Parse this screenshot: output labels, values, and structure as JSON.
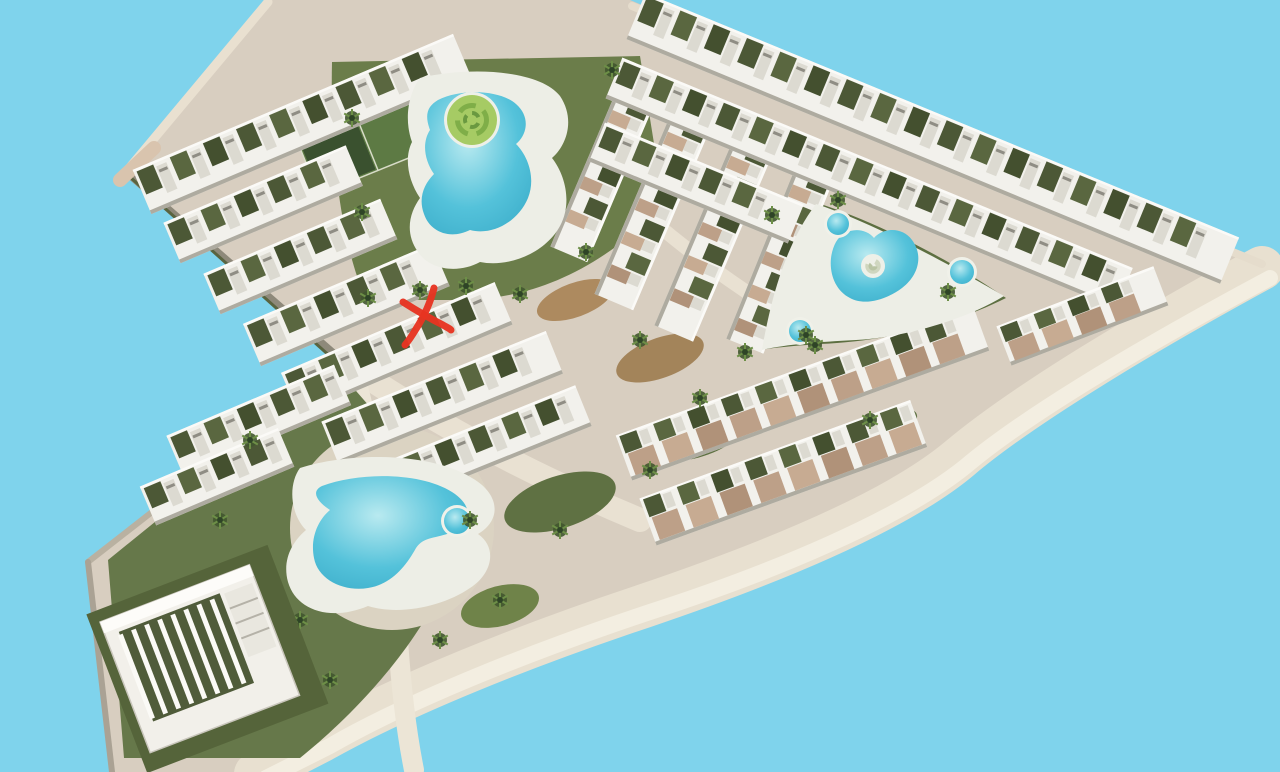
{
  "scene": {
    "width": 1280,
    "height": 772,
    "sky_color": "#7fd3ec",
    "land_color": "#d8cec0",
    "deck_color": "#edeee6",
    "building_white": "#f2f1ec",
    "land_path": "M268,0 L630,0 L1266,264 C1150,326 1022,400 958,454 C894,508 766,560 642,602 C520,642 400,690 318,736 L250,772 L112,772 L88,562 L344,362 L126,172 Z"
  },
  "edges": [
    {
      "name": "band-underside-wall",
      "d": "M126,172 L344,362",
      "c": "#8e897a",
      "w": 7
    },
    {
      "name": "band-underside-hedge",
      "d": "M130,177 L342,367",
      "c": "#5a6440",
      "w": 3
    },
    {
      "name": "triangle-top-wall",
      "d": "M344,362 L88,562",
      "c": "#b9b1a1",
      "w": 6
    },
    {
      "name": "triangle-left-wall",
      "d": "M88,562 L112,772",
      "c": "#aaa294",
      "w": 6
    },
    {
      "name": "band-northwest-wall",
      "d": "M126,172 L268,2",
      "c": "#e9e0d0",
      "w": 9
    },
    {
      "name": "west-corner-cap",
      "d": "M120,180 L154,148",
      "c": "#d9c4ae",
      "w": 14
    }
  ],
  "roads": [
    {
      "name": "perimeter-road",
      "d": "M1262,268 C1148,330 1024,404 960,458 C896,512 768,564 644,606 C524,646 404,694 322,740 L256,774",
      "c": "#e8e0d0",
      "w": 44
    },
    {
      "name": "perimeter-road-outer-stripe",
      "d": "M1270,278 C1154,340 1030,412 966,466 C902,518 774,572 650,612 C530,652 410,700 330,746 L266,778",
      "c": "#f3eee1",
      "w": 16
    },
    {
      "name": "valley-road",
      "d": "M348,364 C430,420 520,470 640,520",
      "c": "#e9e1d2",
      "w": 24
    },
    {
      "name": "north-south-road",
      "d": "M354,372 C378,460 392,560 398,640 C402,700 408,740 414,770",
      "c": "#ece5d6",
      "w": 20
    },
    {
      "name": "ridge-road",
      "d": "M632,6 L1262,264",
      "c": "#e5dccc",
      "w": 8
    },
    {
      "name": "central-link-road",
      "d": "M640,210 C700,262 758,302 812,332",
      "c": "#e9e1d2",
      "w": 14
    },
    {
      "name": "triangle-path-a",
      "d": "M120,570 C200,560 280,600 320,660",
      "c": "#e3dbcb",
      "w": 12
    },
    {
      "name": "triangle-path-b",
      "d": "M200,470 C260,500 300,560 310,640",
      "c": "#e3dbcb",
      "w": 10
    }
  ],
  "greens": [
    {
      "name": "north-garden",
      "d": "M332,62 L640,56 L664,206 C600,268 540,296 470,300 L366,300 C340,240 330,150 332,62 Z",
      "c": "#6b7d4a"
    },
    {
      "name": "east-pool-garden",
      "d": "M814,202 C880,222 960,266 1006,298 C950,326 880,342 820,344 C790,346 772,348 760,350 C766,300 782,244 814,202 Z",
      "c": "#5d6f41"
    },
    {
      "name": "south-triangle-garden",
      "d": "M108,560 L340,372 C380,420 408,448 428,470 L436,600 C400,668 340,726 300,758 L124,758 Z",
      "c": "#66784a"
    }
  ],
  "ellipses": [
    {
      "name": "mulch-island-a",
      "cx": 575,
      "cy": 300,
      "rx": 40,
      "ry": 17,
      "rot": -20,
      "c": "#ad8a5f"
    },
    {
      "name": "mulch-island-b",
      "cx": 660,
      "cy": 358,
      "rx": 46,
      "ry": 20,
      "rot": -20,
      "c": "#a3845a"
    },
    {
      "name": "lawn-patch-a",
      "cx": 700,
      "cy": 432,
      "rx": 52,
      "ry": 24,
      "rot": -20,
      "c": "#5f7143"
    },
    {
      "name": "lawn-patch-b",
      "cx": 560,
      "cy": 502,
      "rx": 58,
      "ry": 26,
      "rot": -18,
      "c": "#5f7143"
    },
    {
      "name": "lawn-patch-c",
      "cx": 500,
      "cy": 606,
      "rx": 40,
      "ry": 20,
      "rot": -15,
      "c": "#6f8349"
    },
    {
      "name": "lawn-patch-d",
      "cx": 880,
      "cy": 430,
      "rx": 40,
      "ry": 16,
      "rot": -24,
      "c": "#5f7143"
    }
  ],
  "paved_circle": {
    "cx": 392,
    "cy": 528,
    "r": 102,
    "c": "#dbd3c2"
  },
  "tennis_court": {
    "x": 300,
    "y": 148,
    "ang": -22,
    "w": 128,
    "h": 50,
    "c_light": "#5d7a44",
    "c_dark": "#3a512f",
    "line": "#d8dcc8"
  },
  "building_rows": [
    {
      "x": 142,
      "y": 192,
      "len": 348,
      "dep": 48,
      "ang": -23,
      "roof": "olive"
    },
    {
      "x": 172,
      "y": 243,
      "len": 198,
      "dep": 44,
      "ang": -23,
      "roof": "olive"
    },
    {
      "x": 212,
      "y": 294,
      "len": 192,
      "dep": 44,
      "ang": -23,
      "roof": "olive"
    },
    {
      "x": 252,
      "y": 345,
      "len": 205,
      "dep": 46,
      "ang": -23,
      "roof": "olive"
    },
    {
      "x": 290,
      "y": 394,
      "len": 232,
      "dep": 46,
      "ang": -23,
      "roof": "olive"
    },
    {
      "x": 330,
      "y": 443,
      "len": 242,
      "dep": 46,
      "ang": -22,
      "roof": "olive"
    },
    {
      "x": 372,
      "y": 491,
      "len": 228,
      "dep": 44,
      "ang": -22,
      "roof": "olive"
    },
    {
      "x": 175,
      "y": 456,
      "len": 182,
      "dep": 44,
      "ang": -23,
      "roof": "olive"
    },
    {
      "x": 148,
      "y": 506,
      "len": 150,
      "dep": 42,
      "ang": -23,
      "roof": "olive"
    },
    {
      "x": 636,
      "y": 96,
      "len": 172,
      "dep": 40,
      "ang": 113,
      "roof": "mixed"
    },
    {
      "x": 692,
      "y": 118,
      "len": 200,
      "dep": 42,
      "ang": 113,
      "roof": "mixed"
    },
    {
      "x": 755,
      "y": 142,
      "len": 208,
      "dep": 42,
      "ang": 113,
      "roof": "mixed"
    },
    {
      "x": 816,
      "y": 170,
      "len": 190,
      "dep": 40,
      "ang": 112,
      "roof": "mixed"
    },
    {
      "x": 636,
      "y": 16,
      "len": 642,
      "dep": 50,
      "ang": 22.4,
      "roof": "olive"
    },
    {
      "x": 614,
      "y": 78,
      "len": 552,
      "dep": 44,
      "ang": 22.4,
      "roof": "olive"
    },
    {
      "x": 597,
      "y": 142,
      "len": 215,
      "dep": 42,
      "ang": 22.4,
      "roof": "olive"
    },
    {
      "x": 648,
      "y": 522,
      "len": 288,
      "dep": 50,
      "ang": -20,
      "roof": "tan"
    },
    {
      "x": 624,
      "y": 458,
      "len": 380,
      "dep": 48,
      "ang": -20,
      "roof": "tan"
    },
    {
      "x": 1004,
      "y": 346,
      "len": 168,
      "dep": 42,
      "ang": -21,
      "roof": "tan"
    }
  ],
  "row_palette": {
    "olive": [
      "#4c5836",
      "#5a6740",
      "#44502f"
    ],
    "tan": [
      "#bda088",
      "#c7ab92",
      "#b09279"
    ],
    "balcony": "#dcdad1",
    "window": "#8f8d84",
    "shadow": "#aeaba0",
    "highlight": "#fbfaf7"
  },
  "pools": [
    {
      "name": "lagoon-pool",
      "deck": "M420,78 C470,66 540,70 560,96 C576,120 566,146 552,158 C566,176 572,204 560,226 C546,252 510,268 480,262 C458,274 430,270 418,252 C404,232 410,212 420,198 C408,180 404,158 412,142 C404,120 408,94 420,78 Z",
      "water": "M438,100 C462,88 500,90 516,104 C530,116 528,134 516,144 C528,156 536,178 528,198 C518,222 492,236 470,230 C450,240 430,232 424,214 C418,198 424,184 434,174 C424,160 422,142 430,130 C424,114 428,106 438,100 Z",
      "island": {
        "cx": 472,
        "cy": 120,
        "r": 25,
        "fill": "#a6cb64",
        "swirl": "#7fae48",
        "swirl2": "#6a9940"
      },
      "rings": []
    },
    {
      "name": "east-oasis-pool",
      "deck": "M816,204 C872,222 956,268 1004,296 C962,322 898,338 856,340 C818,342 788,344 762,350 C770,304 784,246 816,204 Z",
      "water": "M836,242 C844,228 864,226 874,238 C882,228 902,226 912,240 C924,256 918,276 902,288 C886,300 864,306 850,298 C830,288 826,260 836,242 Z",
      "island": {
        "cx": 873,
        "cy": 266,
        "r": 9,
        "fill": "#eef0e8",
        "swirl": "#cfd6bf",
        "swirl2": "#b9c4a4"
      },
      "rings": [
        {
          "cx": 838,
          "cy": 224,
          "r": 11
        },
        {
          "cx": 962,
          "cy": 272,
          "r": 12
        },
        {
          "cx": 800,
          "cy": 331,
          "r": 11
        }
      ]
    },
    {
      "name": "south-pool",
      "deck": "M300,468 C350,452 430,452 472,478 C500,494 502,520 478,534 C498,548 492,574 470,588 C444,606 400,616 368,606 C330,622 296,610 288,582 C282,560 292,542 306,530 C290,514 288,484 300,468 Z",
      "water": "M322,486 C360,472 420,472 452,492 C474,506 472,524 452,532 C436,539 424,536 416,548 C406,566 392,584 368,588 C344,592 318,580 314,558 C310,538 318,520 330,510 C318,502 310,492 322,486 Z",
      "island": null,
      "rings": [
        {
          "cx": 457,
          "cy": 521,
          "r": 13
        }
      ]
    }
  ],
  "pool_ring_rim": "#f0f1e9",
  "water_colors": {
    "light": "#b9eaf0",
    "mid": "#54c2da",
    "deep": "#3fb0cc"
  },
  "trees": [
    [
      368,
      298
    ],
    [
      420,
      290
    ],
    [
      466,
      286
    ],
    [
      520,
      294
    ],
    [
      352,
      118
    ],
    [
      362,
      212
    ],
    [
      612,
      70
    ],
    [
      586,
      252
    ],
    [
      640,
      340
    ],
    [
      700,
      398
    ],
    [
      745,
      352
    ],
    [
      815,
      345
    ],
    [
      772,
      215
    ],
    [
      838,
      200
    ],
    [
      948,
      292
    ],
    [
      806,
      335
    ],
    [
      650,
      470
    ],
    [
      560,
      530
    ],
    [
      500,
      600
    ],
    [
      440,
      640
    ],
    [
      330,
      680
    ],
    [
      220,
      520
    ],
    [
      160,
      600
    ],
    [
      470,
      520
    ],
    [
      870,
      420
    ],
    [
      250,
      440
    ],
    [
      300,
      620
    ]
  ],
  "tree_colors": {
    "canopy": "#41572f",
    "frond": "#6d8f47",
    "core": "#2e4426"
  },
  "pavilion": {
    "x": 100,
    "y": 622,
    "ang": -21,
    "w": 160,
    "h": 140,
    "body": "#f2f0ea",
    "court": "#505c3a",
    "column": "#fbfaf6",
    "wing": "#e9e7df",
    "wing_line": "#b5b2a8",
    "roof": "#fdfcf9",
    "outline": "#c9c6bc"
  },
  "marker": {
    "label": "hand-drawn red X marking a unit location",
    "cx": 423,
    "cy": 317,
    "color": "#e73421",
    "stroke_width": 7,
    "stroke1": "M434,288 C431,300 425,315 416,329 C413,334 410,339 405,345",
    "stroke2": "M403,302 C414,309 429,318 443,325 C446,327 449,328 451,330"
  }
}
